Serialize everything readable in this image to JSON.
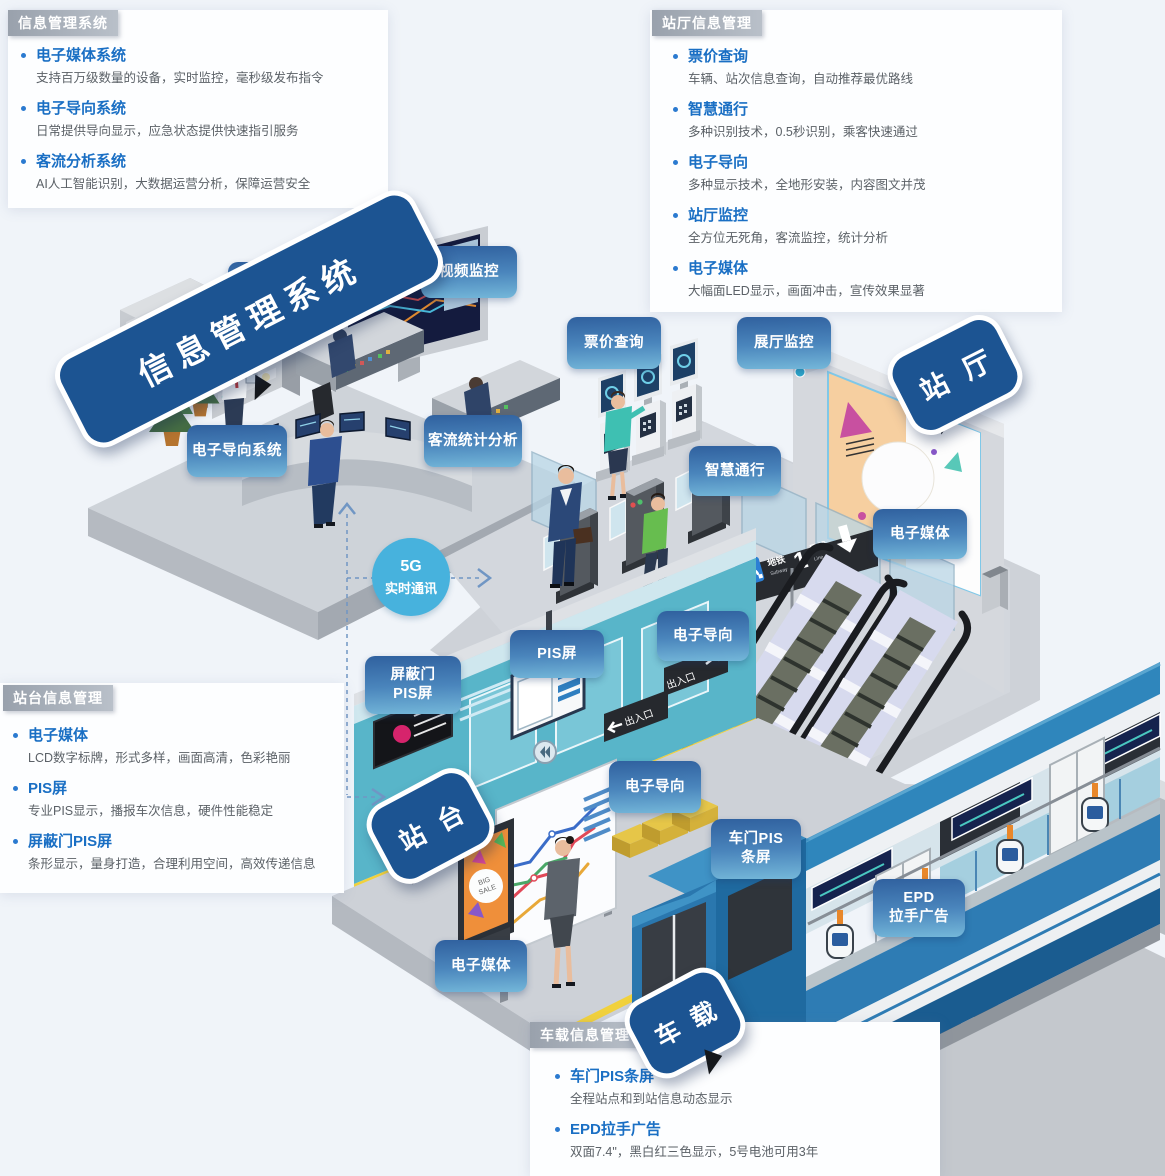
{
  "panels": {
    "info_system": {
      "header": "信息管理系统",
      "items": [
        {
          "title": "电子媒体系统",
          "desc": "支持百万级数量的设备，实时监控，毫秒级发布指令"
        },
        {
          "title": "电子导向系统",
          "desc": "日常提供导向显示，应急状态提供快速指引服务"
        },
        {
          "title": "客流分析系统",
          "desc": "AI人工智能识别，大数据运营分析，保障运营安全"
        }
      ]
    },
    "hall": {
      "header": "站厅信息管理",
      "items": [
        {
          "title": "票价查询",
          "desc": "车辆、站次信息查询，自动推荐最优路线"
        },
        {
          "title": "智慧通行",
          "desc": "多种识别技术，0.5秒识别，乘客快速通过"
        },
        {
          "title": "电子导向",
          "desc": "多种显示技术，全地形安装，内容图文并茂"
        },
        {
          "title": "站厅监控",
          "desc": "全方位无死角，客流监控，统计分析"
        },
        {
          "title": "电子媒体",
          "desc": "大幅面LED显示，画面冲击，宣传效果显著"
        }
      ]
    },
    "platform": {
      "header": "站台信息管理",
      "items": [
        {
          "title": "电子媒体",
          "desc": "LCD数字标牌，形式多样，画面高清，色彩艳丽"
        },
        {
          "title": "PIS屏",
          "desc": "专业PIS显示，播报车次信息，硬件性能稳定"
        },
        {
          "title": "屏蔽门PIS屏",
          "desc": "条形显示，量身打造，合理利用空间，高效传递信息"
        }
      ]
    },
    "onboard": {
      "header": "车载信息管理",
      "items": [
        {
          "title": "车门PIS条屏",
          "desc": "全程站点和到站信息动态显示"
        },
        {
          "title": "EPD拉手广告",
          "desc": "双面7.4\"，黑白红三色显示，5号电池可用3年"
        }
      ]
    }
  },
  "bubbles": {
    "control_room": "信息管理系统",
    "hall": "站 厅",
    "platform": "站 台",
    "train": "车 载"
  },
  "labels": {
    "media_system": "电子媒体系统",
    "video_monitor": "视频监控",
    "guide_system": "电子导向系统",
    "flow_stats": "客流统计分析",
    "fare_query": "票价查询",
    "hall_monitor": "展厅监控",
    "smart_pass": "智慧通行",
    "hall_media": "电子媒体",
    "pis_screen": "PIS屏",
    "psd_pis_l1": "屏蔽门",
    "psd_pis_l2": "PIS屏",
    "guide_top": "电子导向",
    "guide_mid": "电子导向",
    "door_pis_l1": "车门PIS",
    "door_pis_l2": "条屏",
    "epd_l1": "EPD",
    "epd_l2": "拉手广告",
    "platform_media": "电子媒体"
  },
  "connector": {
    "l1": "5G",
    "l2": "实时通讯"
  },
  "signage": {
    "transfer": "换乘",
    "transfer_en": "Transfer",
    "metro": "地铁",
    "metro_en": "Subway",
    "line_number": "1",
    "line_suffix": "号线",
    "line_en": "Line",
    "exit": "出入口",
    "poster_l1": "BIG",
    "poster_l2": "SALE"
  },
  "colors": {
    "label_gradient_top": "#30619f",
    "label_gradient_bottom": "#74b7d9",
    "speech_bubble_blue": "#1c5492",
    "teal_wall": "#58b5c9",
    "train_blue": "#2e7cb4",
    "safety_yellow": "#f1d13c",
    "five_g_circle": "#47b2dd",
    "title_blue": "#1a6fc4",
    "header_gray": "#a5adb8"
  }
}
